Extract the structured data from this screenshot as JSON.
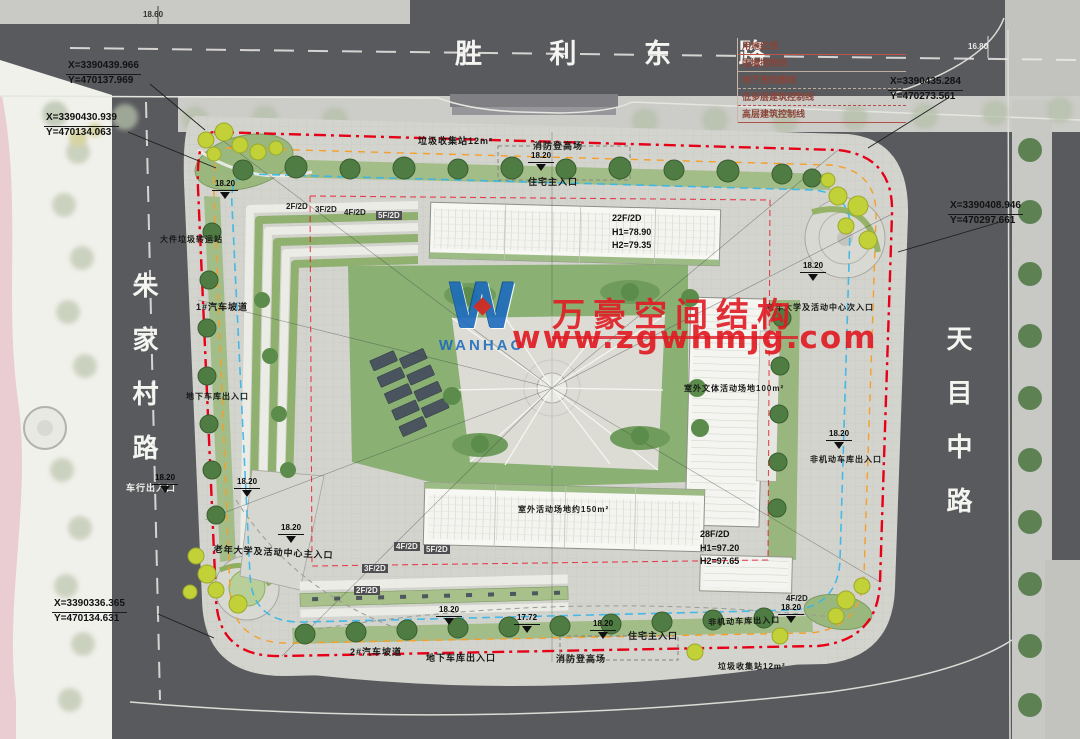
{
  "plan": {
    "roads": {
      "north": "胜 利 东 路",
      "west": "朱家村路",
      "east": "天目中路"
    },
    "legend": {
      "items": [
        "用地红线",
        "围墙控制线",
        "地下室轮廓线",
        "低多层建筑控制线",
        "高层建筑控制线"
      ]
    },
    "coordinates": [
      {
        "x": "X=3390439.966",
        "y": "Y=470137.969"
      },
      {
        "x": "X=3390430.939",
        "y": "Y=470134.063"
      },
      {
        "x": "X=3390435.284",
        "y": "Y=470273.561"
      },
      {
        "x": "X=3390408.946",
        "y": "Y=470297.661"
      },
      {
        "x": "X=3390336.365",
        "y": "Y=470134.631"
      }
    ],
    "buildings": {
      "north_tower": {
        "floors": "22F/2D",
        "h1": "H1=78.90",
        "h2": "H2=79.35"
      },
      "south_tower": {
        "floors": "28F/2D",
        "h1": "H1=97.20",
        "h2": "H2=97.65"
      },
      "podium_top": [
        "2F/2D",
        "3F/2D",
        "4F/2D",
        "5F/2D"
      ],
      "podium_bottom": [
        "4F/2D",
        "5F/2D",
        "3F/2D",
        "2F/2D"
      ],
      "podium_right": "4F/2D"
    },
    "labels": {
      "garbage_top": "垃圾收集站12m²",
      "fire_top": "消防登高场",
      "res_main_top": "住宅主入口",
      "bulk_garbage": "大件垃圾转运站",
      "ramp1": "1#汽车坡道",
      "garage_left": "地下车库出入口",
      "vehicle_exit": "车行出入口",
      "senior_main": "老年大学及活动中心主入口",
      "ramp2": "2#汽车坡道",
      "garage_bottom": "地下车库出入口",
      "fire_bottom": "消防登高场",
      "res_main_bottom": "住宅主入口",
      "nonmotor_bottom": "非机动车库出入口",
      "garbage_bottom": "垃圾收集站12m²",
      "senior_secondary": "老年大学及活动中心次入口",
      "outdoor_culture": "室外文体活动场地100m²",
      "nonmotor_right": "非机动车库出入口",
      "outdoor_activity": "室外活动场地约150m²"
    },
    "elevations": {
      "main": "18.20",
      "alt": "17.72",
      "nw": "18.60",
      "ne": "16.80"
    },
    "watermark": {
      "logo_text": "WANHAO",
      "line1": "万豪空间结构",
      "line2": "www.zgwhmjg.com"
    },
    "colors": {
      "boundary_red": "#e60018",
      "setback_orange": "#f59f28",
      "fire_lane_blue": "#35b6e9",
      "watermark_red": "#e01b24",
      "logo_blue": "#1a6ac0"
    }
  }
}
